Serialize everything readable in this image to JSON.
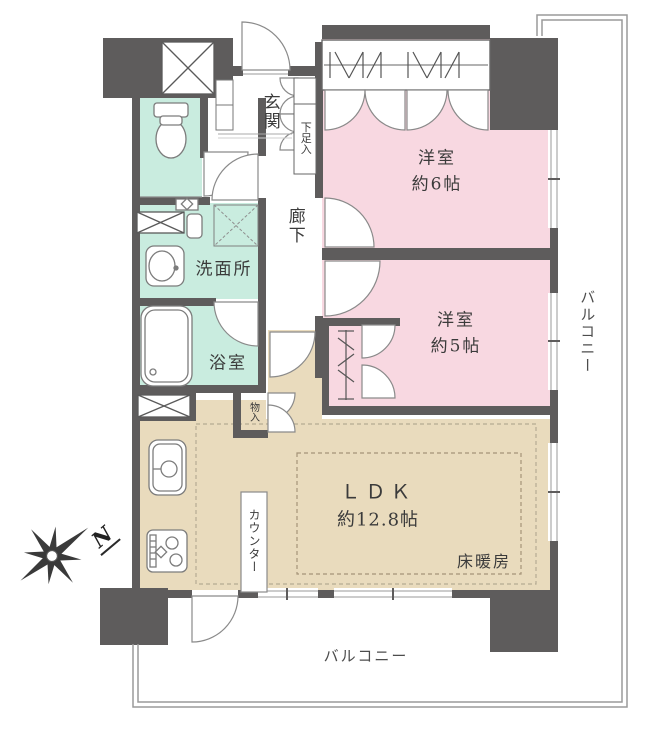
{
  "rooms": {
    "bedroom1": {
      "label": "洋室",
      "size": "約6帖"
    },
    "bedroom2": {
      "label": "洋室",
      "size": "約5帖"
    },
    "ldk": {
      "label": "ＬＤＫ",
      "size": "約12.8帖"
    },
    "floor_heating_label": "床暖房",
    "entrance_label": "玄関",
    "shoe_cabinet_label": "下足入",
    "hallway_label": "廊下",
    "washroom_label": "洗面所",
    "bathroom_label": "浴室",
    "storage_label": "物入",
    "counter_label": "カウンター"
  },
  "balcony": {
    "right_label": "バルコニー",
    "bottom_label": "バルコニー"
  },
  "compass": {
    "north_label": "N"
  },
  "colors": {
    "wall": "#5e5c5c",
    "bedroom_fill": "#f8d8e1",
    "wet_area_fill": "#c9ecdf",
    "ldk_fill": "#e9dbbd"
  }
}
